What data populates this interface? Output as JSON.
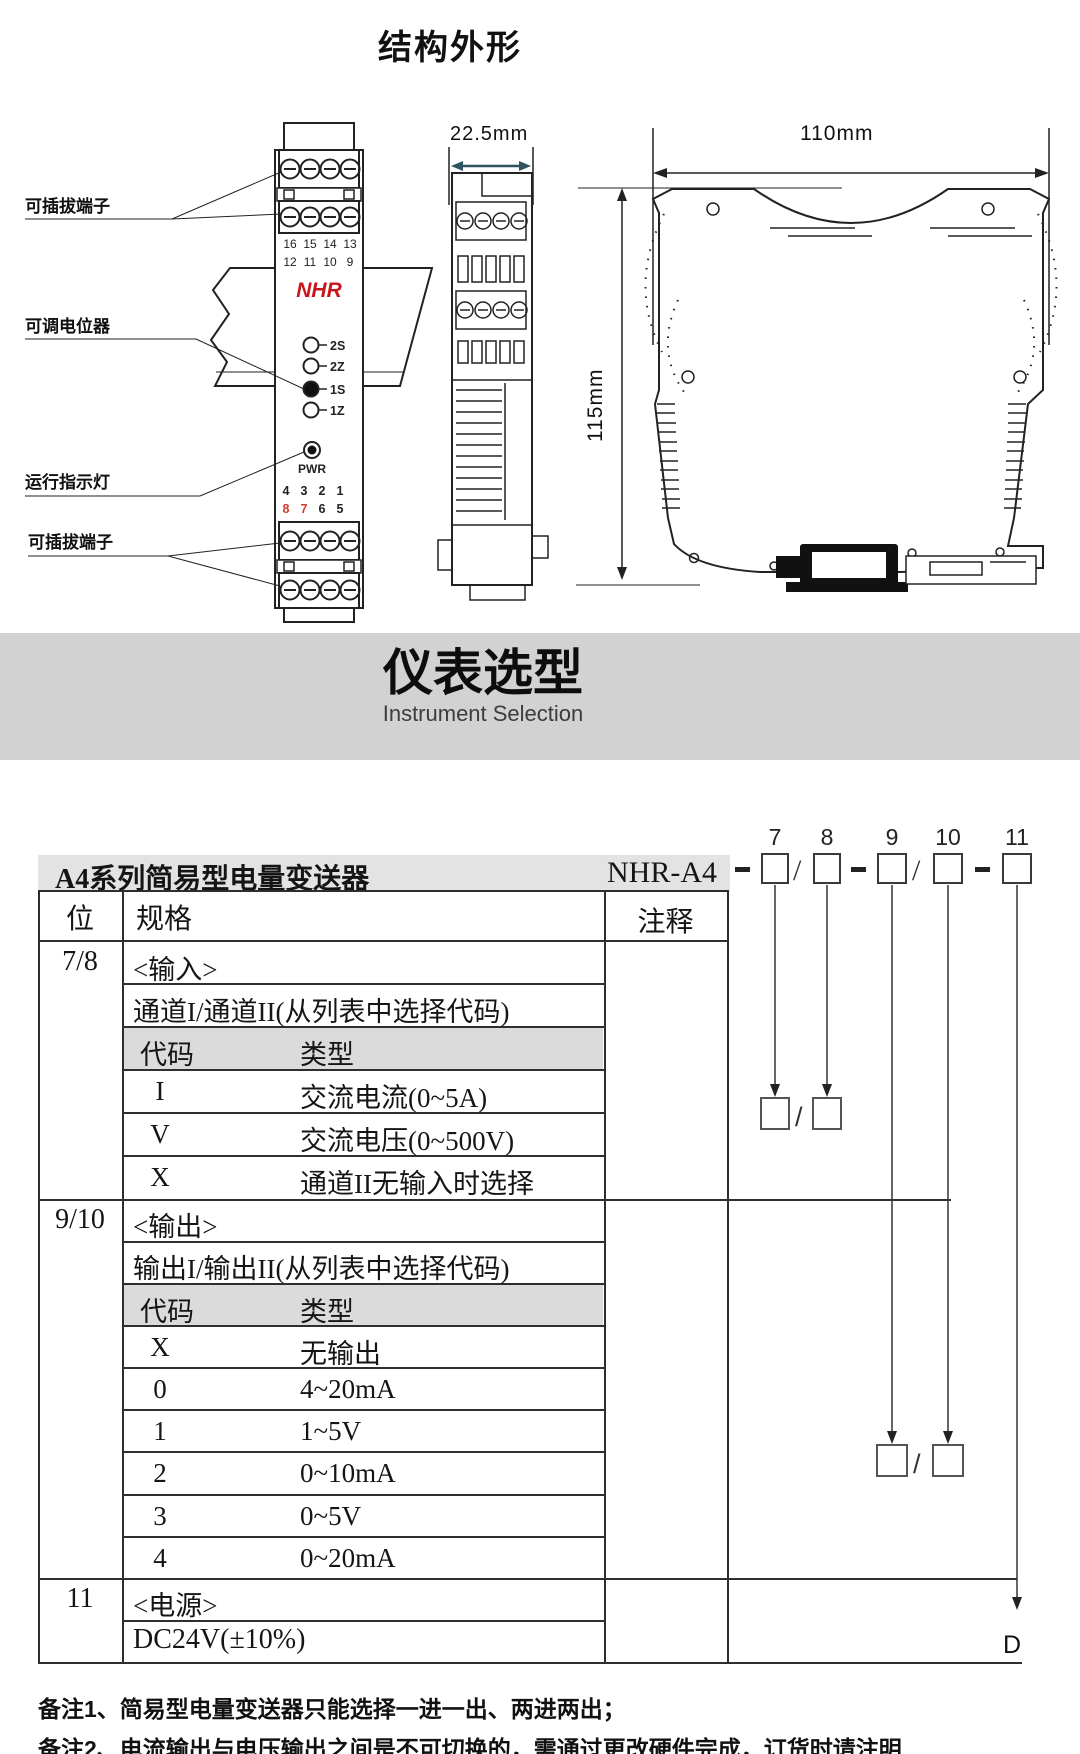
{
  "titles": {
    "structure": "结构外形",
    "selection": "仪表选型",
    "selection_en": "Instrument Selection"
  },
  "colors": {
    "brand_red": "#c8161d",
    "terminal_red": "#cf3a2c",
    "dim_teal": "#2d5560",
    "line": "#222222"
  },
  "diagram": {
    "callouts": {
      "terminal_top": "可插拔端子",
      "potentiometer": "可调电位器",
      "indicator": "运行指示灯",
      "terminal_bottom": "可插拔端子"
    },
    "dims": {
      "w_side": "22.5mm",
      "w_front": "110mm",
      "h": "115mm"
    },
    "front": {
      "brand": "NHR",
      "t1": [
        "16",
        "15",
        "14",
        "13"
      ],
      "t2": [
        "12",
        "11",
        "10",
        "9"
      ],
      "pots": [
        "2S",
        "2Z",
        "1S",
        "1Z"
      ],
      "led": "PWR",
      "n1": [
        "4",
        "3",
        "2",
        "1"
      ],
      "n2": [
        "8",
        "7",
        "6",
        "5"
      ]
    }
  },
  "selection": {
    "product": "A4系列简易型电量变送器",
    "model": "NHR-A4",
    "positions": [
      "7",
      "8",
      "9",
      "10",
      "11"
    ],
    "headers": {
      "pos": "位",
      "spec": "规格",
      "note": "注释"
    },
    "s78": {
      "pos": "7/8",
      "head": "<输入>",
      "desc": "通道I/通道II(从列表中选择代码)",
      "code_h": "代码",
      "type_h": "类型",
      "rows": [
        {
          "code": "I",
          "type": "交流电流(0~5A)"
        },
        {
          "code": "V",
          "type": "交流电压(0~500V)"
        },
        {
          "code": "X",
          "type": "通道II无输入时选择"
        }
      ]
    },
    "s910": {
      "pos": "9/10",
      "head": "<输出>",
      "desc": "输出I/输出II(从列表中选择代码)",
      "code_h": "代码",
      "type_h": "类型",
      "rows": [
        {
          "code": "X",
          "type": "无输出"
        },
        {
          "code": "0",
          "type": "4~20mA"
        },
        {
          "code": "1",
          "type": "1~5V"
        },
        {
          "code": "2",
          "type": "0~10mA"
        },
        {
          "code": "3",
          "type": "0~5V"
        },
        {
          "code": "4",
          "type": "0~20mA"
        }
      ]
    },
    "s11": {
      "pos": "11",
      "head": "<电源>",
      "desc": "DC24V(±10%)"
    },
    "default_code": "D"
  },
  "notes": {
    "n1": "备注1、简易型电量变送器只能选择一进一出、两进两出；",
    "n2": "备注2、电流输出与电压输出之间是不可切换的，需通过更改硬件完成，订货时请注明"
  }
}
